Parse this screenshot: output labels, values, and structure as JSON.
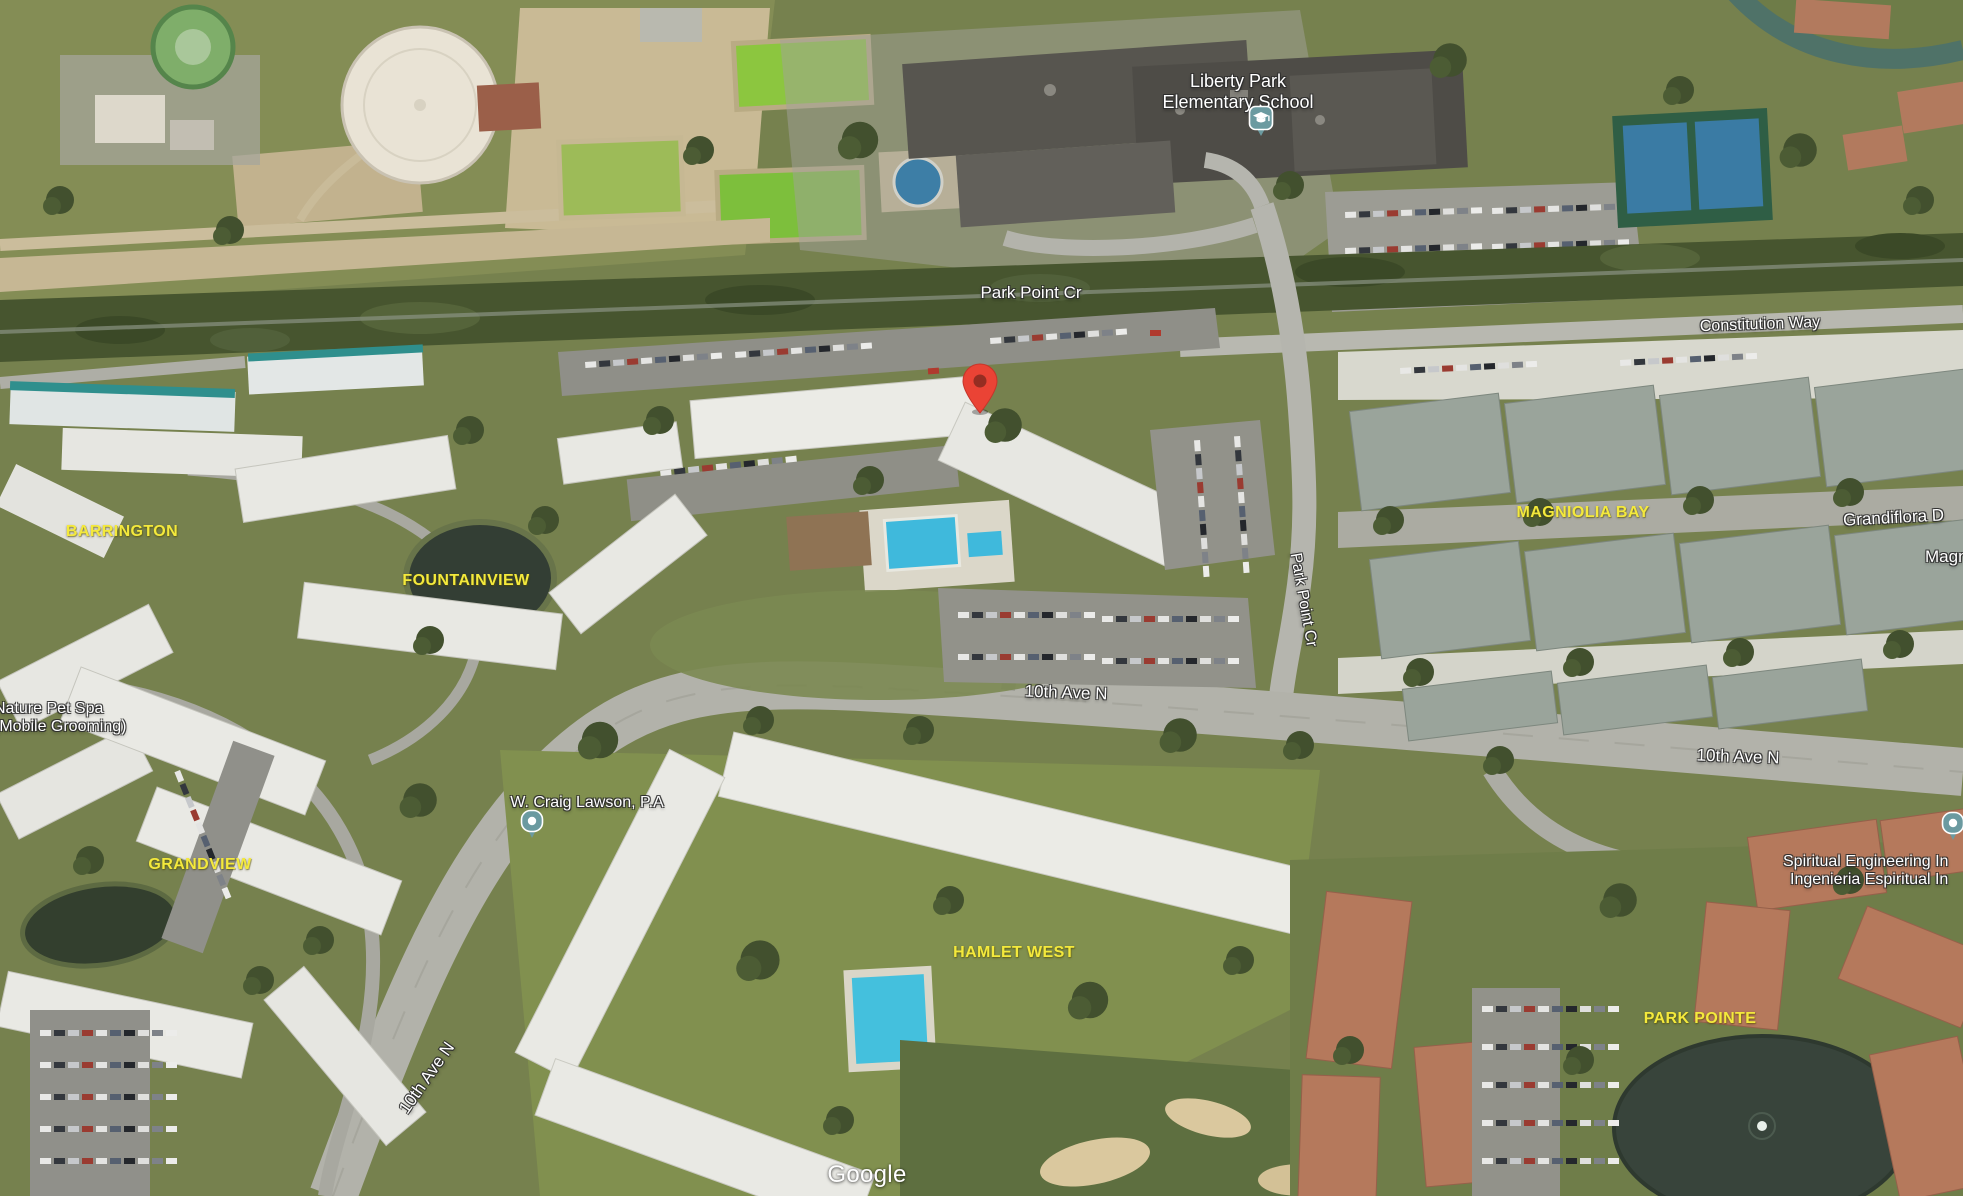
{
  "map": {
    "attribution": "Google",
    "labels": {
      "school": {
        "line1": "Liberty Park",
        "line2": "Elementary School"
      },
      "park_point_cr_top": "Park Point Cr",
      "park_point_cr_side": "Park Point Cr",
      "constitution_way": "Constitution Way",
      "tenth_ave_center": "10th Ave N",
      "tenth_ave_right": "10th Ave N",
      "tenth_ave_left": "10th Ave N",
      "grandiflora": "Grandiflora D",
      "mag_partial": "Magn",
      "neighborhoods": {
        "barrington": "BARRINGTON",
        "fountainview": "FOUNTAINVIEW",
        "grandview": "GRANDVIEW",
        "magniolia_bay": "MAGNIOLIA BAY",
        "hamlet_west": "HAMLET WEST",
        "park_pointe": "PARK POINTE"
      },
      "businesses": {
        "nature_pet_spa": {
          "line1": "Nature Pet Spa",
          "line2": "(Mobile Grooming)"
        },
        "craig_lawson": "W. Craig Lawson, P.A",
        "spiritual": {
          "line1": "Spiritual Engineering In",
          "line2": "Ingenieria Espiritual In"
        }
      }
    },
    "markers": {
      "destination": {
        "name": "destination-pin",
        "color": "#ea4335",
        "hole_color": "#952d22"
      },
      "school_poi": {
        "name": "school-pin",
        "color": "#6b9aa0",
        "glyph": "graduation-cap"
      },
      "generic_poi": {
        "name": "poi-pin",
        "color": "#6b9aa0",
        "glyph": "dot"
      }
    },
    "colors": {
      "neighborhood_label": "#f4e93c",
      "road_label": "#ffffff",
      "pool_water": "#3fb9dc",
      "pond_water": "#38443b",
      "grass": "#76814e"
    }
  }
}
